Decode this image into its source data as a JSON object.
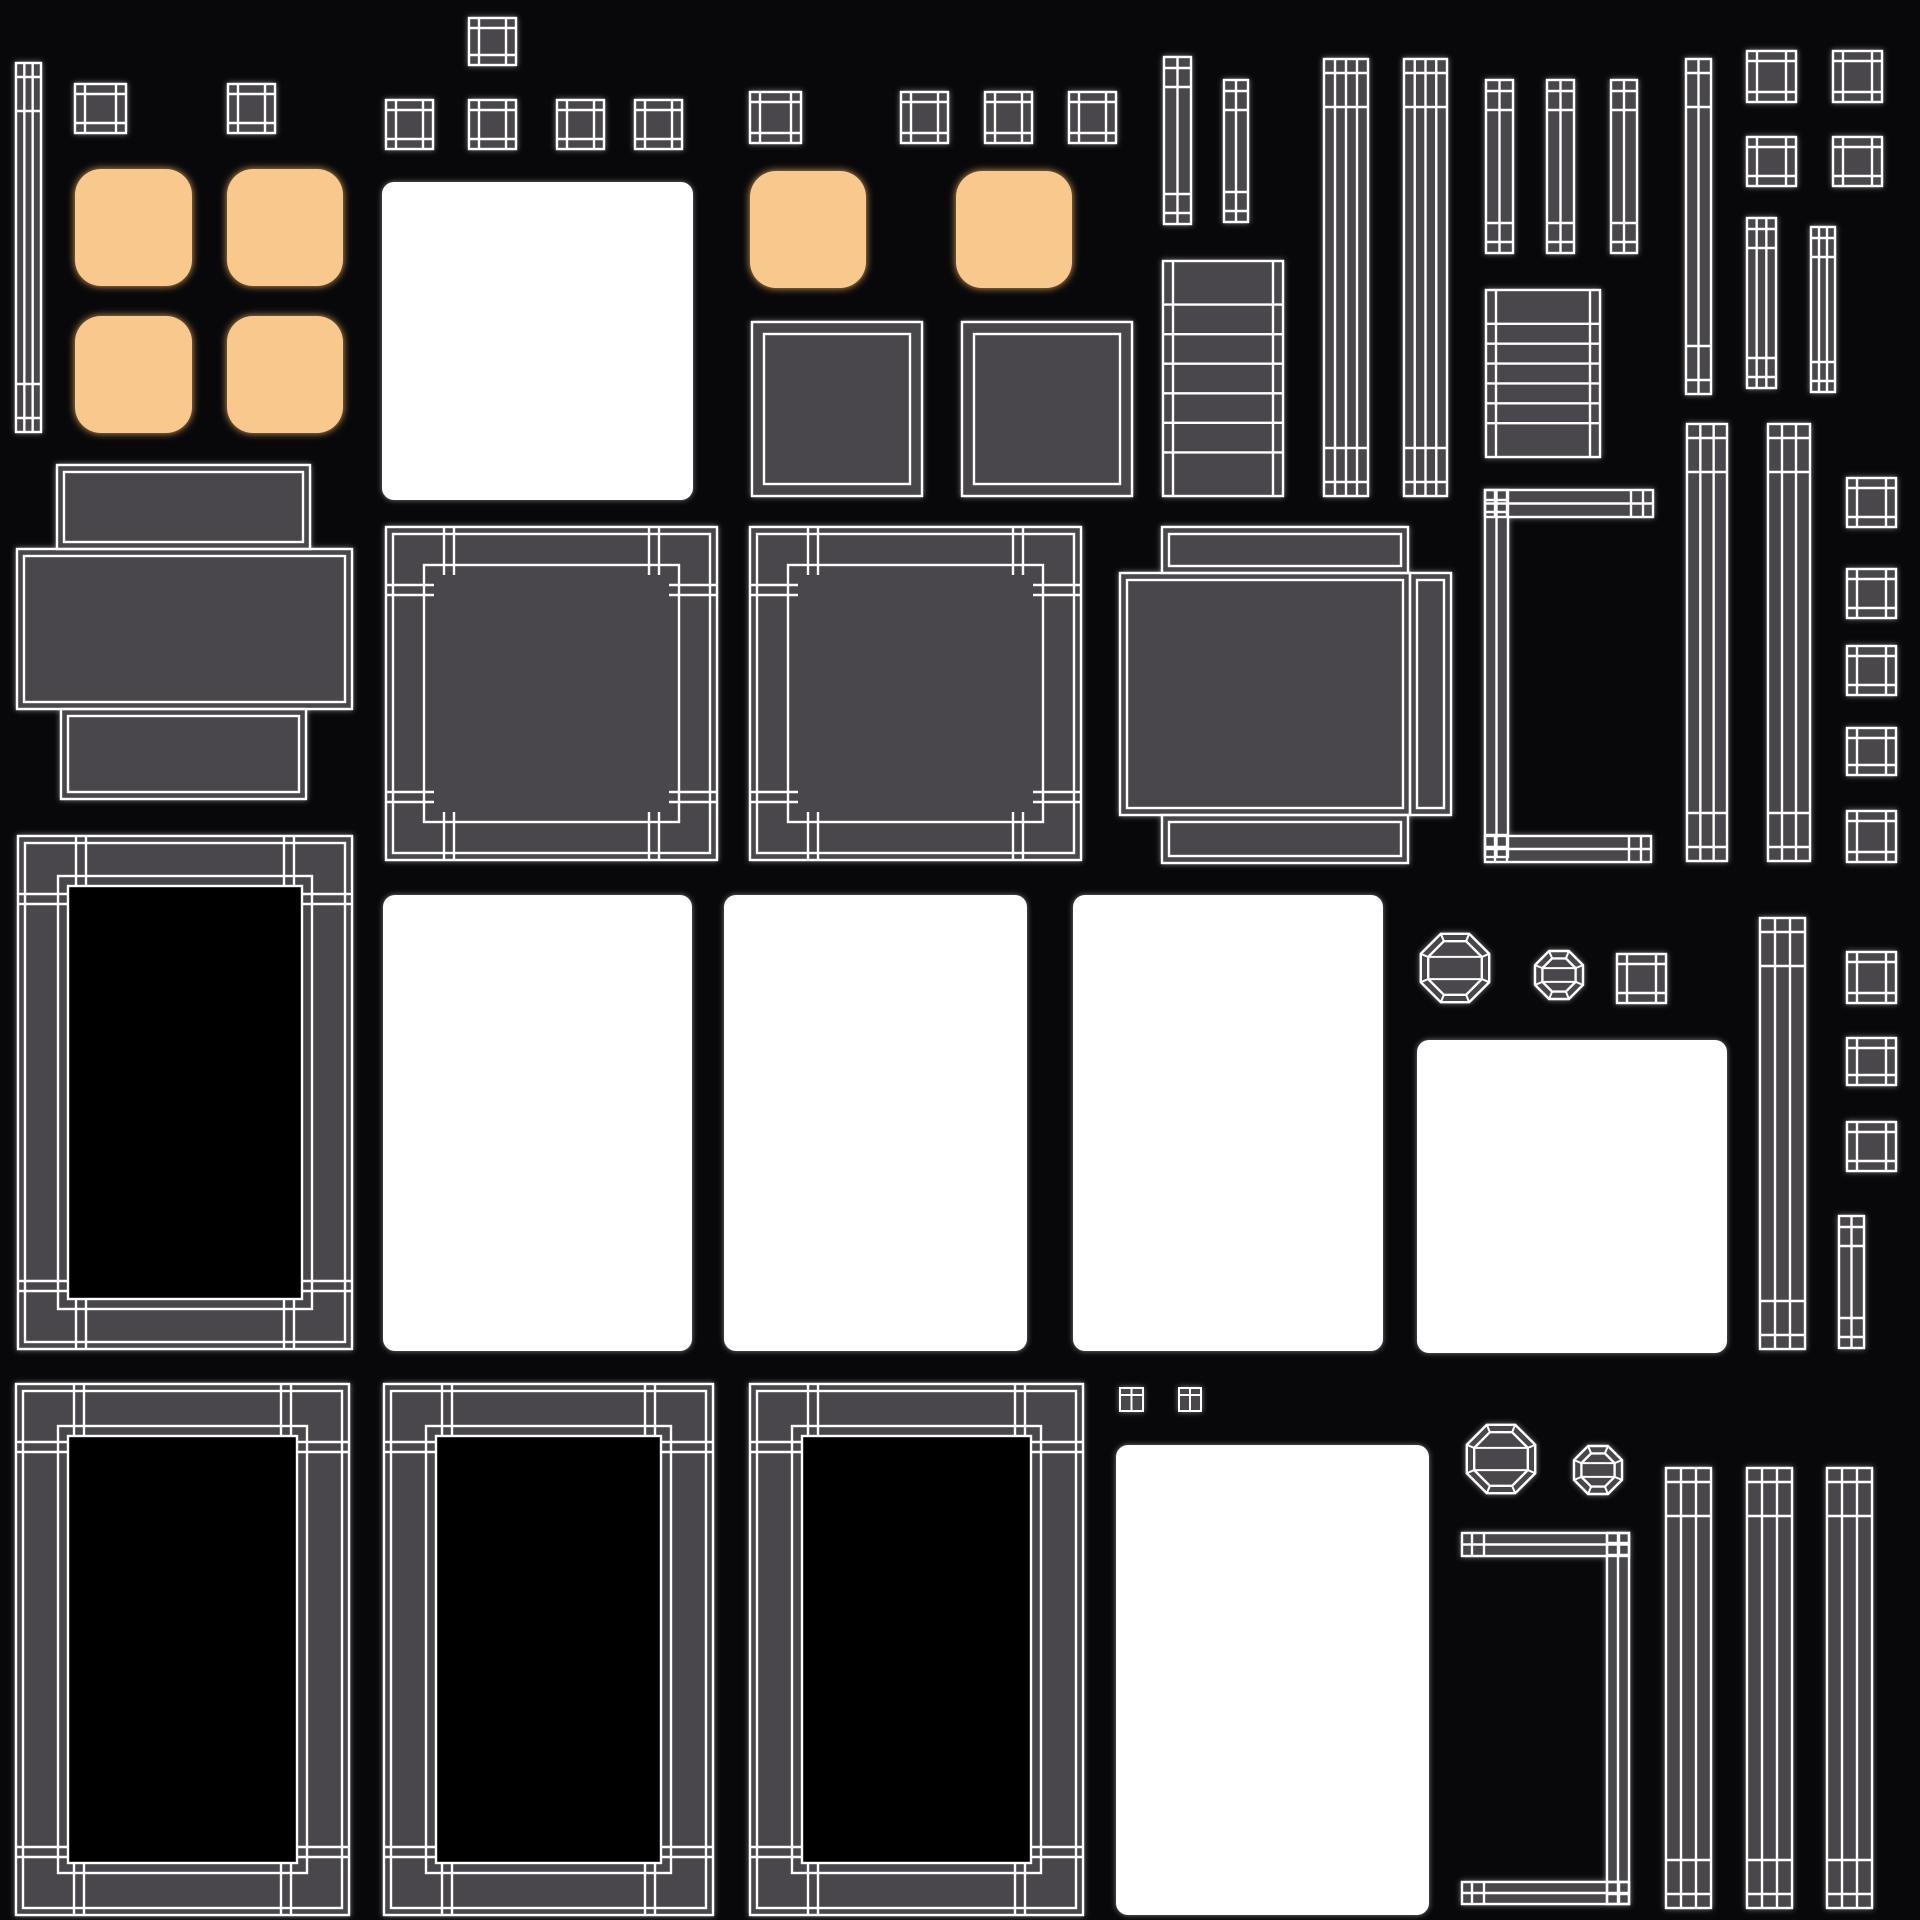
{
  "canvas": {
    "width": 1920,
    "height": 1920
  },
  "colors": {
    "background": "#08080a",
    "island_fill": "#4a474c",
    "wire": "#ffffff",
    "white_patch": "#ffffff",
    "orange_fill": "#f9c88d",
    "orange_glow": "#e8a85f",
    "gray_glow": "#8d8d93",
    "black_center": "#050506"
  },
  "shapes": [
    {
      "name": "island-capped-bar-topleft",
      "type": "bar",
      "x": 16,
      "y": 63,
      "w": 25,
      "h": 369,
      "lines": 2
    },
    {
      "name": "island-window-sq-1",
      "type": "window",
      "x": 75,
      "y": 84,
      "w": 51,
      "h": 49
    },
    {
      "name": "island-window-sq-2",
      "type": "window",
      "x": 228,
      "y": 84,
      "w": 47,
      "h": 49
    },
    {
      "name": "island-window-sq-3",
      "type": "window",
      "x": 469,
      "y": 18,
      "w": 47,
      "h": 47
    },
    {
      "name": "island-window-sq-4",
      "type": "window",
      "x": 386,
      "y": 100,
      "w": 47,
      "h": 49
    },
    {
      "name": "island-window-sq-5",
      "type": "window",
      "x": 469,
      "y": 100,
      "w": 47,
      "h": 49
    },
    {
      "name": "island-window-sq-6",
      "type": "window",
      "x": 557,
      "y": 100,
      "w": 47,
      "h": 49
    },
    {
      "name": "island-window-sq-7",
      "type": "window",
      "x": 635,
      "y": 100,
      "w": 47,
      "h": 49
    },
    {
      "name": "island-window-sq-8",
      "type": "window",
      "x": 750,
      "y": 92,
      "w": 51,
      "h": 51
    },
    {
      "name": "island-window-sq-9",
      "type": "window",
      "x": 901,
      "y": 92,
      "w": 47,
      "h": 51
    },
    {
      "name": "island-window-sq-10",
      "type": "window",
      "x": 985,
      "y": 92,
      "w": 47,
      "h": 51
    },
    {
      "name": "island-window-sq-11",
      "type": "window",
      "x": 1069,
      "y": 92,
      "w": 47,
      "h": 51
    },
    {
      "name": "island-window-sq-12",
      "type": "window",
      "x": 1747,
      "y": 51,
      "w": 49,
      "h": 51
    },
    {
      "name": "island-window-sq-13",
      "type": "window",
      "x": 1833,
      "y": 51,
      "w": 49,
      "h": 51
    },
    {
      "name": "island-window-sq-14",
      "type": "window",
      "x": 1747,
      "y": 137,
      "w": 49,
      "h": 49
    },
    {
      "name": "island-window-sq-15",
      "type": "window",
      "x": 1833,
      "y": 137,
      "w": 49,
      "h": 49
    },
    {
      "name": "island-cushion-orange-1",
      "type": "orange",
      "x": 75,
      "y": 169,
      "w": 117,
      "h": 117
    },
    {
      "name": "island-cushion-orange-2",
      "type": "orange",
      "x": 227,
      "y": 169,
      "w": 116,
      "h": 117
    },
    {
      "name": "island-cushion-orange-3",
      "type": "orange",
      "x": 75,
      "y": 316,
      "w": 117,
      "h": 117
    },
    {
      "name": "island-cushion-orange-4",
      "type": "orange",
      "x": 227,
      "y": 316,
      "w": 116,
      "h": 117
    },
    {
      "name": "island-cushion-orange-5",
      "type": "orange",
      "x": 750,
      "y": 171,
      "w": 116,
      "h": 117
    },
    {
      "name": "island-cushion-orange-6",
      "type": "orange",
      "x": 956,
      "y": 171,
      "w": 116,
      "h": 117
    },
    {
      "name": "island-white-patch-top",
      "type": "white",
      "x": 382,
      "y": 182,
      "w": 311,
      "h": 318
    },
    {
      "name": "island-plain-square-1",
      "type": "plain",
      "x": 752,
      "y": 322,
      "w": 170,
      "h": 174
    },
    {
      "name": "island-plain-square-2",
      "type": "plain",
      "x": 962,
      "y": 322,
      "w": 170,
      "h": 174
    },
    {
      "name": "island-capped-bar-2",
      "type": "bar",
      "x": 1164,
      "y": 57,
      "w": 27,
      "h": 167,
      "lines": 1
    },
    {
      "name": "island-capped-bar-3",
      "type": "bar",
      "x": 1224,
      "y": 80,
      "w": 24,
      "h": 142,
      "lines": 1
    },
    {
      "name": "island-ladder-1",
      "type": "ladder",
      "x": 1163,
      "y": 261,
      "w": 120,
      "h": 235,
      "rungs": 6
    },
    {
      "name": "island-wide-bar-1",
      "type": "bar",
      "x": 1324,
      "y": 59,
      "w": 44,
      "h": 437,
      "lines": 3
    },
    {
      "name": "island-wide-bar-2",
      "type": "bar",
      "x": 1404,
      "y": 59,
      "w": 43,
      "h": 437,
      "lines": 3
    },
    {
      "name": "island-thin-bar-1",
      "type": "bar",
      "x": 1486,
      "y": 80,
      "w": 27,
      "h": 173,
      "lines": 1
    },
    {
      "name": "island-thin-bar-2",
      "type": "bar",
      "x": 1547,
      "y": 80,
      "w": 27,
      "h": 173,
      "lines": 1
    },
    {
      "name": "island-thin-bar-3",
      "type": "bar",
      "x": 1611,
      "y": 80,
      "w": 26,
      "h": 173,
      "lines": 1
    },
    {
      "name": "island-tall-bar-1",
      "type": "bar",
      "x": 1686,
      "y": 59,
      "w": 25,
      "h": 335,
      "lines": 1
    },
    {
      "name": "island-ladder-2",
      "type": "ladder",
      "x": 1486,
      "y": 290,
      "w": 114,
      "h": 167,
      "rungs": 6
    },
    {
      "name": "island-striped-bar-1",
      "type": "bar",
      "x": 1747,
      "y": 218,
      "w": 29,
      "h": 170,
      "lines": 2
    },
    {
      "name": "island-striped-bar-2",
      "type": "bar",
      "x": 1811,
      "y": 227,
      "w": 24,
      "h": 165,
      "lines": 2
    },
    {
      "name": "island-cross-panel-1",
      "type": "cross",
      "rects": [
        [
          57,
          465,
          253,
          84
        ],
        [
          17,
          549,
          335,
          160
        ],
        [
          61,
          709,
          245,
          90
        ]
      ]
    },
    {
      "name": "island-bordered-square-1",
      "type": "frame",
      "x": 386,
      "y": 527,
      "w": 331,
      "h": 333,
      "bw": 48,
      "black": false
    },
    {
      "name": "island-bordered-square-2",
      "type": "frame",
      "x": 750,
      "y": 527,
      "w": 331,
      "h": 333,
      "bw": 48,
      "black": false
    },
    {
      "name": "island-cross-panel-2",
      "type": "cross",
      "rects": [
        [
          1162,
          527,
          246,
          46
        ],
        [
          1120,
          573,
          290,
          242
        ],
        [
          1410,
          573,
          41,
          242
        ],
        [
          1162,
          815,
          246,
          48
        ]
      ]
    },
    {
      "name": "island-bracket-1",
      "type": "bracket",
      "rects": [
        [
          1485,
          490,
          168,
          27
        ],
        [
          1485,
          490,
          23,
          367
        ],
        [
          1485,
          836,
          166,
          26
        ]
      ]
    },
    {
      "name": "island-capped-bar-4",
      "type": "bar",
      "x": 1687,
      "y": 424,
      "w": 40,
      "h": 437,
      "lines": 2
    },
    {
      "name": "island-capped-bar-5",
      "type": "bar",
      "x": 1768,
      "y": 424,
      "w": 42,
      "h": 437,
      "lines": 2
    },
    {
      "name": "island-window-sq-16",
      "type": "window",
      "x": 1847,
      "y": 478,
      "w": 49,
      "h": 49
    },
    {
      "name": "island-window-sq-17",
      "type": "window",
      "x": 1847,
      "y": 569,
      "w": 49,
      "h": 49
    },
    {
      "name": "island-window-sq-18",
      "type": "window",
      "x": 1847,
      "y": 646,
      "w": 49,
      "h": 49
    },
    {
      "name": "island-window-sq-19",
      "type": "window",
      "x": 1847,
      "y": 728,
      "w": 49,
      "h": 47
    },
    {
      "name": "island-window-sq-20",
      "type": "window",
      "x": 1847,
      "y": 811,
      "w": 49,
      "h": 51
    },
    {
      "name": "island-window-sq-21",
      "type": "window",
      "x": 1847,
      "y": 952,
      "w": 49,
      "h": 51
    },
    {
      "name": "island-window-sq-22",
      "type": "window",
      "x": 1847,
      "y": 1038,
      "w": 49,
      "h": 47
    },
    {
      "name": "island-window-sq-23",
      "type": "window",
      "x": 1847,
      "y": 1122,
      "w": 49,
      "h": 49
    },
    {
      "name": "island-picture-frame-1",
      "type": "frame",
      "x": 18,
      "y": 836,
      "w": 334,
      "h": 513,
      "bw": 50,
      "black": true
    },
    {
      "name": "island-white-patch-mid-1",
      "type": "white",
      "x": 383,
      "y": 895,
      "w": 309,
      "h": 456
    },
    {
      "name": "island-white-patch-mid-2",
      "type": "white",
      "x": 724,
      "y": 895,
      "w": 303,
      "h": 456
    },
    {
      "name": "island-white-patch-mid-3",
      "type": "white",
      "x": 1073,
      "y": 895,
      "w": 310,
      "h": 456
    },
    {
      "name": "island-white-patch-mid-4",
      "type": "white",
      "x": 1417,
      "y": 1040,
      "w": 310,
      "h": 313
    },
    {
      "name": "island-octagon-big-1",
      "type": "oct",
      "cx": 1455,
      "cy": 968,
      "r": 37
    },
    {
      "name": "island-octagon-small-1",
      "type": "oct",
      "cx": 1559,
      "cy": 975,
      "r": 26
    },
    {
      "name": "island-window-sq-24",
      "type": "window",
      "x": 1617,
      "y": 954,
      "w": 49,
      "h": 49
    },
    {
      "name": "island-striped-bar-3",
      "type": "bar",
      "x": 1760,
      "y": 918,
      "w": 45,
      "h": 431,
      "lines": 2
    },
    {
      "name": "island-stub-bar-1",
      "type": "bar",
      "x": 1839,
      "y": 1216,
      "w": 25,
      "h": 132,
      "lines": 1
    },
    {
      "name": "island-picture-frame-2",
      "type": "frame",
      "x": 16,
      "y": 1384,
      "w": 333,
      "h": 531,
      "bw": 52,
      "black": true
    },
    {
      "name": "island-picture-frame-3",
      "type": "frame",
      "x": 384,
      "y": 1384,
      "w": 329,
      "h": 531,
      "bw": 52,
      "black": true
    },
    {
      "name": "island-picture-frame-4",
      "type": "frame",
      "x": 750,
      "y": 1384,
      "w": 333,
      "h": 531,
      "bw": 52,
      "black": true
    },
    {
      "name": "island-tiny-sq-1",
      "type": "tiny2",
      "x": 1120,
      "y": 1388,
      "w": 23,
      "h": 23
    },
    {
      "name": "island-tiny-sq-2",
      "type": "tiny2",
      "x": 1179,
      "y": 1388,
      "w": 22,
      "h": 23
    },
    {
      "name": "island-white-patch-bottom",
      "type": "white",
      "x": 1116,
      "y": 1445,
      "w": 313,
      "h": 470
    },
    {
      "name": "island-octagon-big-2",
      "type": "oct",
      "cx": 1501,
      "cy": 1459,
      "r": 37
    },
    {
      "name": "island-octagon-small-2",
      "type": "oct",
      "cx": 1598,
      "cy": 1470,
      "r": 26
    },
    {
      "name": "island-bracket-2",
      "type": "bracket",
      "rects": [
        [
          1462,
          1533,
          167,
          23
        ],
        [
          1607,
          1533,
          22,
          371
        ],
        [
          1462,
          1882,
          167,
          22
        ]
      ]
    },
    {
      "name": "island-capped-bar-6",
      "type": "bar",
      "x": 1666,
      "y": 1468,
      "w": 45,
      "h": 440,
      "lines": 2
    },
    {
      "name": "island-capped-bar-7",
      "type": "bar",
      "x": 1747,
      "y": 1468,
      "w": 45,
      "h": 440,
      "lines": 2
    },
    {
      "name": "island-capped-bar-8",
      "type": "bar",
      "x": 1827,
      "y": 1468,
      "w": 45,
      "h": 440,
      "lines": 2
    }
  ]
}
